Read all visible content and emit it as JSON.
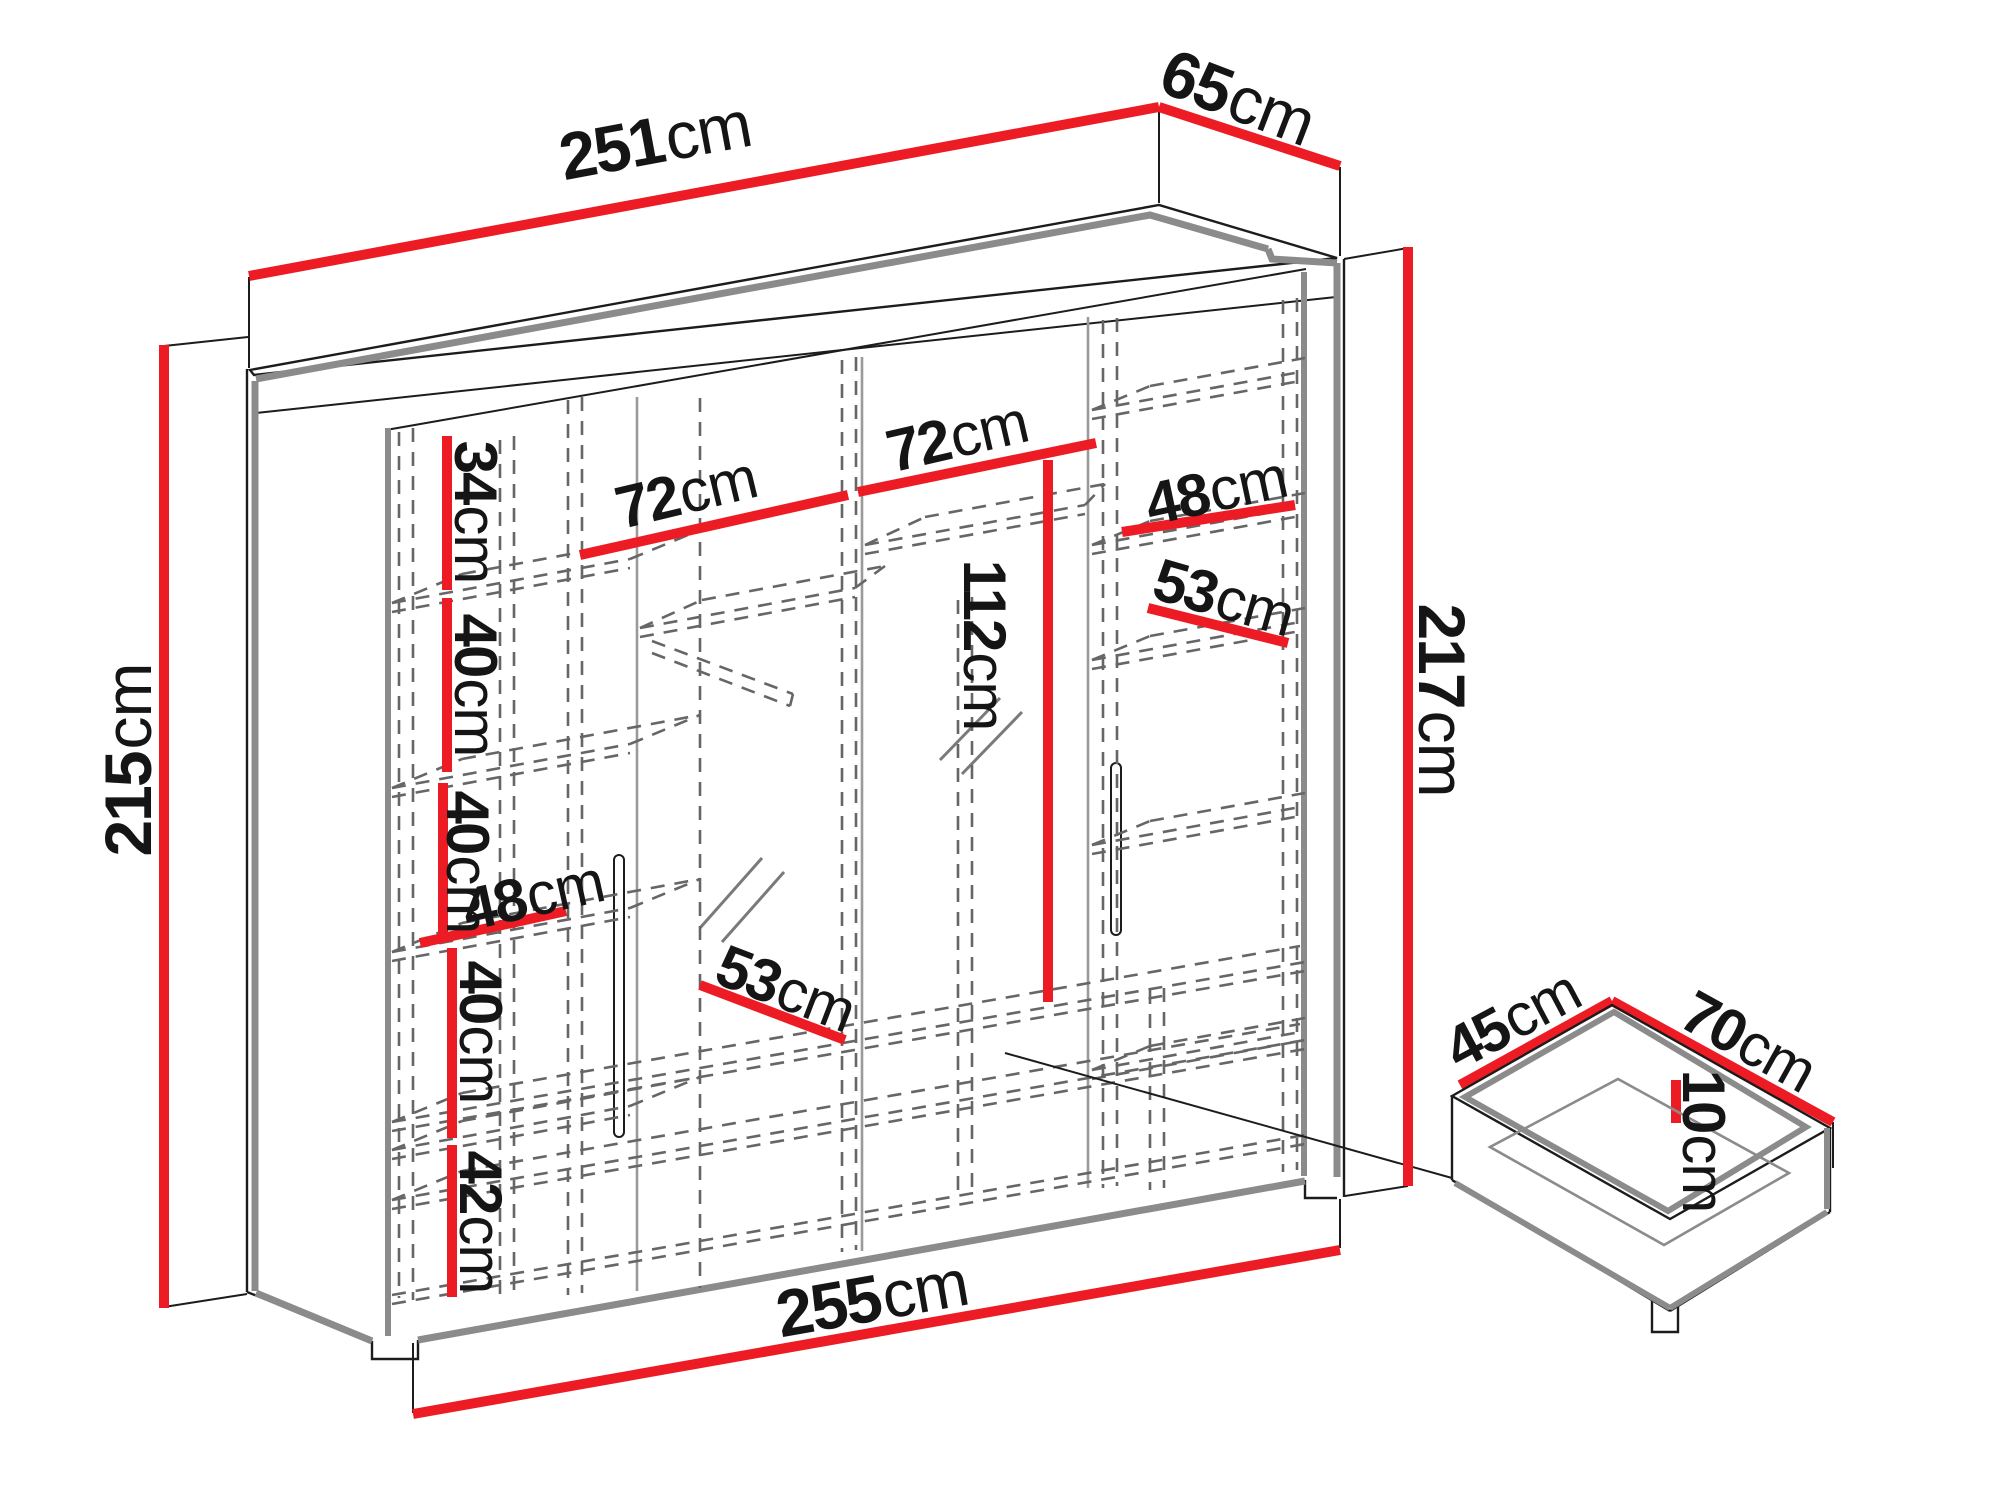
{
  "diagram": {
    "kind": "wardrobe-dimension-diagram",
    "unit": "cm",
    "colors": {
      "dimension_line": "#ED1C24",
      "outline": "#1c1c1c",
      "panel_gray": "#8b8b8b",
      "dashed_gray": "#666666"
    }
  },
  "wardrobe": {
    "overall": [
      {
        "id": "top-width",
        "value": "251",
        "unit": "cm"
      },
      {
        "id": "top-depth",
        "value": "65",
        "unit": "cm"
      },
      {
        "id": "left-height",
        "value": "215",
        "unit": "cm"
      },
      {
        "id": "right-height",
        "value": "217",
        "unit": "cm"
      },
      {
        "id": "bottom-width",
        "value": "255",
        "unit": "cm"
      }
    ],
    "interior": [
      {
        "id": "left-section-1",
        "value": "34",
        "unit": "cm"
      },
      {
        "id": "left-section-2",
        "value": "40",
        "unit": "cm"
      },
      {
        "id": "left-section-3",
        "value": "40",
        "unit": "cm"
      },
      {
        "id": "left-section-4",
        "value": "40",
        "unit": "cm"
      },
      {
        "id": "left-section-5",
        "value": "42",
        "unit": "cm"
      },
      {
        "id": "left-shelf-width",
        "value": "48",
        "unit": "cm"
      },
      {
        "id": "mid-left-shelf-width",
        "value": "72",
        "unit": "cm"
      },
      {
        "id": "mid-right-shelf-width",
        "value": "72",
        "unit": "cm"
      },
      {
        "id": "hanging-height",
        "value": "112",
        "unit": "cm"
      },
      {
        "id": "bottom-shelf-depth",
        "value": "53",
        "unit": "cm"
      },
      {
        "id": "right-shelf-width",
        "value": "48",
        "unit": "cm"
      },
      {
        "id": "right-shelf-depth",
        "value": "53",
        "unit": "cm"
      }
    ],
    "drawer": [
      {
        "id": "drawer-depth",
        "value": "45",
        "unit": "cm"
      },
      {
        "id": "drawer-width",
        "value": "70",
        "unit": "cm"
      },
      {
        "id": "drawer-height",
        "value": "10",
        "unit": "cm"
      }
    ]
  }
}
